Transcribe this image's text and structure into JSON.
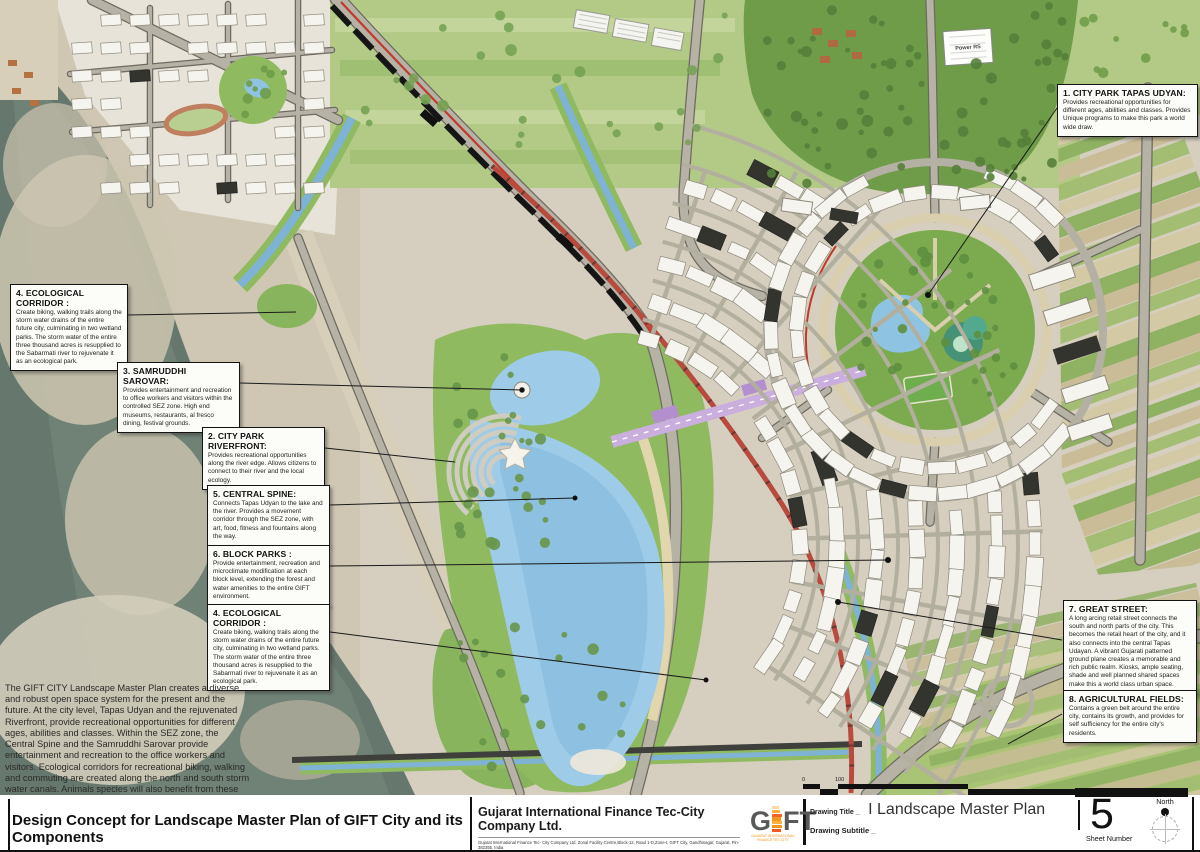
{
  "colors": {
    "brand_orange": "#f7941d",
    "great_street_red": "#b84a3e",
    "lake_blue": "#9ecbe8",
    "river": "#66776d",
    "park_green": "#8fba5f"
  },
  "callouts": [
    {
      "title": "1. CITY PARK TAPAS UDYAN:",
      "body": "Provides recreational opportunities for different ages, abilities and classes. Provides Unique programs to make this park a world wide draw."
    },
    {
      "title": "4. ECOLOGICAL CORRIDOR :",
      "body": "Create biking, walking trails along the storm water drains of the entire future city, culminating in two wetland parks. The storm water of the entire three thousand acres is resupplied to the Sabarmati river to rejuvenate it as an ecological park."
    },
    {
      "title": "3. SAMRUDDHI SAROVAR:",
      "body": "Provides entertainment and recreation to office workers and visitors within the controlled SEZ zone. High end museums, restaurants, al fresco dining, festival grounds."
    },
    {
      "title": "2. CITY PARK RIVERFRONT:",
      "body": "Provides recreational opportunities along the river edge. Allows citizens to connect to their river and the local ecology."
    },
    {
      "title": "5. CENTRAL SPINE:",
      "body": "Connects Tapas Udyan to the lake and the river. Provides a movement corridor through the SEZ zone, with art, food, fitness and fountains along the way."
    },
    {
      "title": "6. BLOCK PARKS :",
      "body": "Provide entertainment, recreation and microclimate modification at each block level, extending the forest and water amenities to the entire GIFT environment."
    },
    {
      "title": "4. ECOLOGICAL CORRIDOR :",
      "body": "Create biking, walking trails along the storm water drains of the entire future city, culminating in two wetland parks. The storm water of the entire three thousand acres is resupplied to the Sabarmati river to rejuvenate it as an ecological park."
    },
    {
      "title": "7. GREAT STREET:",
      "body": "A long arcing retail street connects the south and north parts of the city.  This becomes the retail heart of the city, and it also connects into the central Tapas Udayan. A vibrant Gujarati patterned ground plane creates a memorable and rich public realm.  Kiosks, ample seating, shade and well planned shared spaces make this a world class urban space."
    },
    {
      "title": "8. AGRICULTURAL FIELDS:",
      "body": "Contains a green belt around the entire city, contains its growth, and provides for self sufficiency for the entire city's residents."
    }
  ],
  "description": "The GIFT CITY Landscape Master Plan creates a diverse and robust open space system for the present and the future.  At the city level, Tapas Udyan and the rejuvenated Riverfront, provide recreational opportunities for different ages, abilities and classes. Within the SEZ zone, the Central Spine and the Samruddhi Sarovar provide entertainment and recreation to the office workers and visitors. Ecological corridors for recreational biking, walking and commuting are created along the north and south storm water canals.  Animals species will also benefit from these waterways.  A third ecological corridor is reintroduced that drains Tapas Udyan through the central canal to the river. A belt of Agriculture Fields rings the entire city to make it food self-sufficient. A Great Street arcs through the city connecting north to south, creating a vibrant retail district.",
  "map_labels": {
    "power_station": "Power RS"
  },
  "footer": {
    "sheet_title": "Design Concept for Landscape Master Plan of GIFT City and its Components",
    "company_name": "Gujarat International Finance Tec-City Company Ltd.",
    "company_address": "Gujarat International Finance Tec- City Company Ltd. Zonal Facility Centre,Block-12, Road 1-D,Zone-I, GIFT City, Gandhinagar, Gujarat, Pin-382355, India",
    "logo_letter_g": "G",
    "logo_letters_ft": "FT",
    "logo_sub1": "GUJARAT INTERNATIONAL",
    "logo_sub2": "FINANCE TEC-CITY",
    "drawing_title_label": "Drawing Title _",
    "drawing_title": "I Landscape Master Plan",
    "drawing_subtitle_label": "Drawing Subtitle _",
    "sheet_number": "5",
    "sheet_number_label": "Sheet Number",
    "north_label": "North"
  },
  "scalebar": {
    "top_left": "0",
    "top_mid": "100",
    "bottom_left": "50",
    "bottom_mid": "500"
  }
}
